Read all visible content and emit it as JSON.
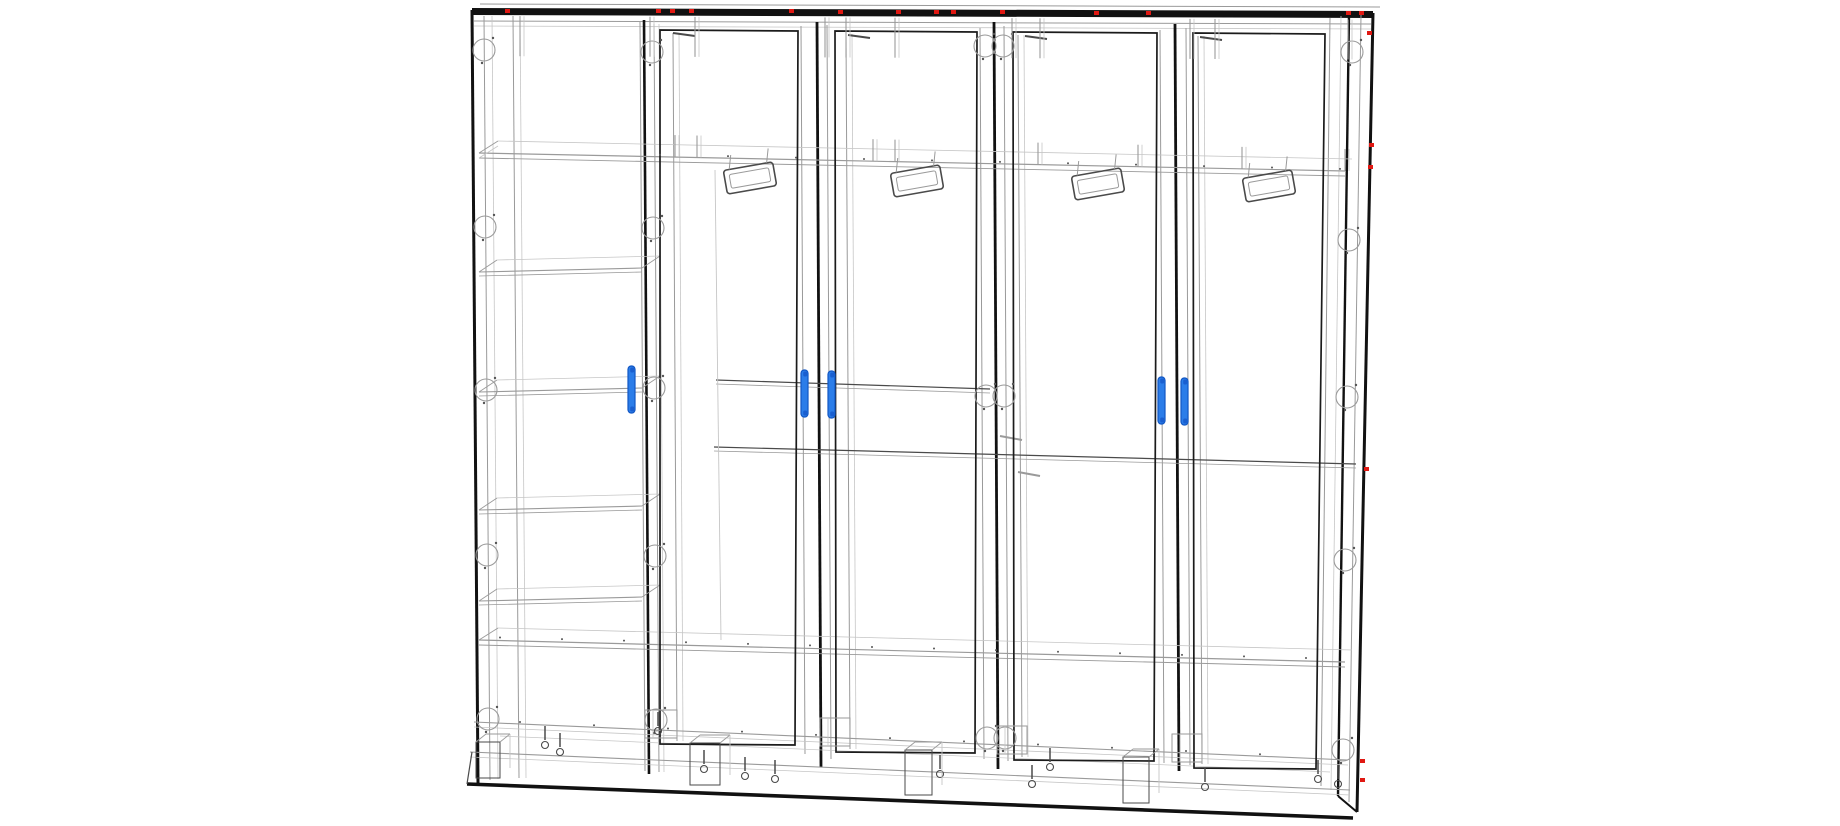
{
  "canvas": {
    "width": 1840,
    "height": 826,
    "background": "#ffffff"
  },
  "palette": {
    "k": "#111111",
    "m": "#4a4a4a",
    "t": "#9a9a9a",
    "f": "#c6c6c6",
    "dot": "#555555",
    "handle": "#2b7de9",
    "handle_edge": "#1257c4",
    "handle_cap": "#1a5fd0",
    "red": "#e01812"
  },
  "lines": [
    [
      472,
      11.5,
      1373,
      14.5,
      7,
      "k"
    ],
    [
      480,
      4,
      1380,
      7,
      1,
      "t"
    ],
    [
      474,
      21,
      1371,
      24,
      1,
      "t"
    ],
    [
      474,
      26,
      1371,
      29,
      0.8,
      "f"
    ],
    [
      472,
      10,
      478,
      783,
      3,
      "k"
    ],
    [
      484,
      16,
      490,
      780,
      1,
      "t"
    ],
    [
      492,
      16,
      498,
      779,
      0.8,
      "f"
    ],
    [
      513,
      16,
      519,
      778,
      1,
      "t"
    ],
    [
      520,
      16,
      526,
      778,
      0.8,
      "f"
    ],
    [
      640,
      22,
      645,
      771,
      1,
      "t"
    ],
    [
      644,
      20,
      649,
      774,
      2.6,
      "k"
    ],
    [
      654,
      24,
      659,
      772,
      1,
      "t"
    ],
    [
      659,
      24,
      664,
      772,
      0.8,
      "f"
    ],
    [
      673,
      33,
      677,
      741,
      1,
      "t"
    ],
    [
      679,
      33,
      683,
      741,
      0.8,
      "f"
    ],
    [
      801,
      26,
      805,
      754,
      1,
      "t"
    ],
    [
      817,
      22,
      821,
      767,
      2.8,
      "k"
    ],
    [
      827,
      25,
      831,
      759,
      1,
      "t"
    ],
    [
      846,
      34,
      850,
      749,
      1,
      "t"
    ],
    [
      852,
      34,
      856,
      749,
      0.8,
      "f"
    ],
    [
      980,
      28,
      984,
      759,
      1,
      "t"
    ],
    [
      994,
      22,
      998,
      769,
      2.8,
      "k"
    ],
    [
      1004,
      26,
      1008,
      761,
      1,
      "t"
    ],
    [
      1018,
      35,
      1022,
      757,
      1,
      "t"
    ],
    [
      1024,
      35,
      1028,
      757,
      0.8,
      "f"
    ],
    [
      1160,
      30,
      1164,
      763,
      1,
      "t"
    ],
    [
      1175,
      24,
      1179,
      771,
      2.8,
      "k"
    ],
    [
      1186,
      28,
      1190,
      765,
      1,
      "t"
    ],
    [
      1198,
      36,
      1202,
      764,
      1,
      "t"
    ],
    [
      1204,
      36,
      1208,
      764,
      0.8,
      "f"
    ],
    [
      1330,
      18,
      1321,
      786,
      1,
      "t"
    ],
    [
      1341,
      16,
      1331,
      790,
      0.8,
      "f"
    ],
    [
      1349,
      14,
      1338,
      796,
      2.4,
      "k"
    ],
    [
      1361,
      15,
      1349,
      802,
      1,
      "t"
    ],
    [
      1373,
      13,
      1357,
      812,
      3,
      "k"
    ],
    [
      479,
      153,
      1345,
      171,
      1.2,
      "t"
    ],
    [
      479,
      158,
      1345,
      176,
      0.9,
      "t"
    ],
    [
      498,
      141,
      1352,
      159,
      0.8,
      "f"
    ],
    [
      479,
      153,
      498,
      141,
      0.9,
      "t"
    ],
    [
      479,
      158,
      498,
      146,
      0.8,
      "f"
    ],
    [
      479,
      640,
      1345,
      662,
      1.2,
      "t"
    ],
    [
      479,
      645,
      1345,
      667,
      0.9,
      "t"
    ],
    [
      498,
      628,
      1352,
      650,
      0.8,
      "f"
    ],
    [
      479,
      640,
      498,
      628,
      0.9,
      "t"
    ],
    [
      474,
      722,
      1348,
      760,
      1.1,
      "t"
    ],
    [
      474,
      727,
      1348,
      765,
      0.8,
      "f"
    ],
    [
      470,
      752,
      1350,
      790,
      1.1,
      "t"
    ],
    [
      470,
      757,
      1350,
      795,
      0.8,
      "f"
    ],
    [
      467,
      784,
      1353,
      818,
      3.6,
      "k"
    ],
    [
      500,
      736,
      1330,
      772,
      0.7,
      "f"
    ],
    [
      716,
      380,
      990,
      389,
      1.2,
      "m"
    ],
    [
      716,
      384,
      990,
      393,
      0.8,
      "t"
    ],
    [
      714,
      447,
      1356,
      464,
      1.2,
      "m"
    ],
    [
      714,
      451,
      1356,
      468,
      0.8,
      "t"
    ],
    [
      715,
      170,
      721,
      640,
      0.9,
      "f"
    ],
    [
      673,
      33,
      695,
      36,
      2,
      "m"
    ],
    [
      848,
      35,
      870,
      38,
      2,
      "m"
    ],
    [
      1025,
      36,
      1047,
      39,
      2,
      "m"
    ],
    [
      1200,
      37,
      1222,
      40,
      2,
      "m"
    ],
    [
      1000,
      436,
      1022,
      440,
      2,
      "t"
    ],
    [
      1018,
      472,
      1040,
      476,
      2,
      "t"
    ],
    [
      1357,
      812,
      1338,
      796,
      2,
      "k"
    ],
    [
      467,
      784,
      472,
      752,
      1.2,
      "m"
    ]
  ],
  "door_panels": [
    {
      "points": [
        [
          660,
          30
        ],
        [
          798,
          31
        ],
        [
          795,
          745
        ],
        [
          660,
          744
        ]
      ]
    },
    {
      "points": [
        [
          835,
          31
        ],
        [
          977,
          32
        ],
        [
          975,
          753
        ],
        [
          836,
          752
        ]
      ]
    },
    {
      "points": [
        [
          1013,
          32
        ],
        [
          1157,
          33
        ],
        [
          1154,
          761
        ],
        [
          1014,
          760
        ]
      ]
    },
    {
      "points": [
        [
          1193,
          33
        ],
        [
          1325,
          34
        ],
        [
          1316,
          769
        ],
        [
          1194,
          768
        ]
      ]
    }
  ],
  "shelves": {
    "x_front_left": 479,
    "x_front_right": 642,
    "depth_dx": 18,
    "depth_dy": -12,
    "front_drop": -4,
    "levels": [
      272,
      392,
      510,
      601
    ]
  },
  "cam_locks": {
    "radius": 11,
    "positions": [
      [
        484,
        50
      ],
      [
        485,
        227
      ],
      [
        486,
        390
      ],
      [
        487,
        555
      ],
      [
        488,
        719
      ],
      [
        652,
        52
      ],
      [
        653,
        228
      ],
      [
        654,
        388
      ],
      [
        655,
        556
      ],
      [
        656,
        720
      ],
      [
        985,
        46
      ],
      [
        1003,
        46
      ],
      [
        986,
        396
      ],
      [
        1004,
        396
      ],
      [
        987,
        738
      ],
      [
        1005,
        738
      ],
      [
        1352,
        52
      ],
      [
        1349,
        240
      ],
      [
        1347,
        397
      ],
      [
        1345,
        560
      ],
      [
        1343,
        750
      ]
    ]
  },
  "red_marks": {
    "size": [
      5,
      4
    ],
    "top_row": [
      [
        505,
        9
      ],
      [
        656,
        9
      ],
      [
        670,
        9
      ],
      [
        689,
        9
      ],
      [
        789,
        9
      ],
      [
        838,
        10
      ],
      [
        896,
        10
      ],
      [
        934,
        10
      ],
      [
        951,
        10
      ],
      [
        1000,
        10
      ],
      [
        1094,
        11
      ],
      [
        1146,
        11
      ],
      [
        1346,
        11
      ],
      [
        1359,
        11
      ]
    ],
    "right_edge": [
      [
        1367,
        31
      ],
      [
        1369,
        143
      ],
      [
        1368,
        165
      ],
      [
        1364,
        467
      ],
      [
        1360,
        759
      ],
      [
        1360,
        778
      ]
    ]
  },
  "handles": {
    "width": 7,
    "height": 47,
    "positions": [
      [
        628,
        366
      ],
      [
        801,
        370
      ],
      [
        828,
        371
      ],
      [
        1158,
        377
      ],
      [
        1181,
        378
      ]
    ]
  },
  "hangers": {
    "angle": -10,
    "outer": [
      50,
      24
    ],
    "inner": [
      40,
      14
    ],
    "positions": [
      [
        750,
        178
      ],
      [
        917,
        181
      ],
      [
        1098,
        184
      ],
      [
        1269,
        186
      ]
    ]
  },
  "pegs_top": {
    "height": 40,
    "y_base": 16,
    "slope": 0.004,
    "xref": 472,
    "xs": [
      520,
      650,
      695,
      825,
      846,
      895,
      1012,
      1040,
      1190,
      1215,
      1348
    ]
  },
  "pegs_shelf": {
    "height": 22,
    "y_base": 153,
    "slope": 0.0208,
    "xref": 479,
    "xs": [
      675,
      697,
      873,
      895,
      1038,
      1138,
      1242,
      1345
    ]
  },
  "bolts": [
    [
      545,
      726
    ],
    [
      560,
      733
    ],
    [
      658,
      712
    ],
    [
      704,
      750
    ],
    [
      745,
      757
    ],
    [
      775,
      760
    ],
    [
      940,
      755
    ],
    [
      1032,
      765
    ],
    [
      1050,
      748
    ],
    [
      1205,
      768
    ],
    [
      1318,
      760
    ],
    [
      1338,
      765
    ]
  ],
  "plinth_blocks": [
    [
      476,
      742,
      24,
      36
    ],
    [
      690,
      743,
      30,
      42
    ],
    [
      905,
      750,
      27,
      45
    ],
    [
      1123,
      757,
      26,
      46
    ]
  ],
  "foot_brackets": [
    [
      645,
      710,
      32,
      28
    ],
    [
      820,
      718,
      30,
      28
    ],
    [
      997,
      726,
      30,
      28
    ],
    [
      1172,
      734,
      30,
      28
    ]
  ],
  "dot_rows": [
    {
      "x0": 660,
      "x1": 1340,
      "step": 68,
      "y_base": 151,
      "slope": 0.0208,
      "xref": 479
    },
    {
      "x0": 500,
      "x1": 1340,
      "step": 62,
      "y_base": 637,
      "slope": 0.0254,
      "xref": 479
    },
    {
      "x0": 520,
      "x1": 1330,
      "step": 74,
      "y_base": 720,
      "slope": 0.0435,
      "xref": 474
    }
  ]
}
